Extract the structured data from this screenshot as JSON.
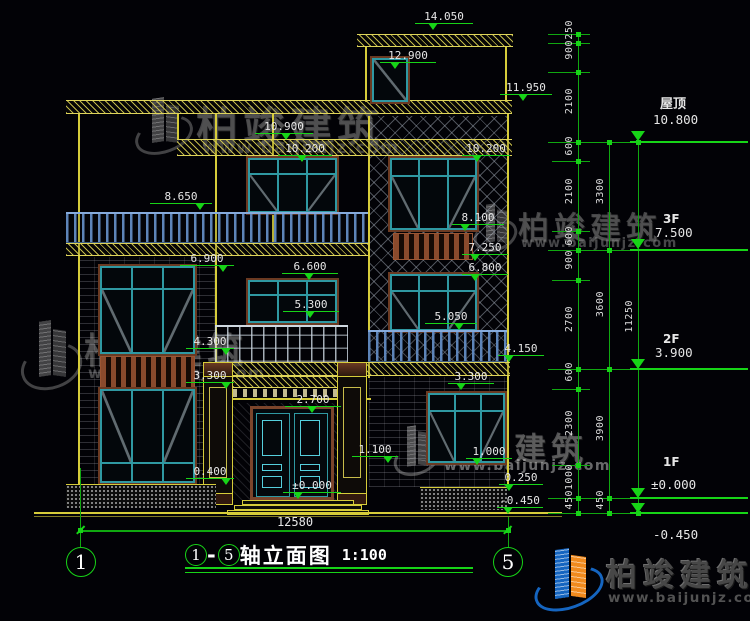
{
  "titlebar": {
    "axis_start": "1",
    "axis_end": "5",
    "dash": "-",
    "title": "轴立面图",
    "scale": "1:100"
  },
  "overall_width": "12580",
  "axis_bubbles": {
    "left": "1",
    "right": "5"
  },
  "markers": {
    "m14050": "14.050",
    "m12900": "12.900",
    "m11950": "11.950",
    "m10900": "10.900",
    "m10200c": "10.200",
    "m10200r": "10.200",
    "m8650": "8.650",
    "m8100": "8.100",
    "m7250": "7.250",
    "m6900": "6.900",
    "m6800": "6.800",
    "m6600": "6.600",
    "m5300": "5.300",
    "m5050": "5.050",
    "m4300": "4.300",
    "m4150": "4.150",
    "m3300l": "3.300",
    "m3300r": "3.300",
    "m2700": "2.700",
    "m1100": "1.100",
    "m1000": "1.000",
    "m0400": "0.400",
    "m0250": "0.250",
    "m0000": "±0.000",
    "mneg0450": "-0.450"
  },
  "levels": {
    "roof_label": "屋顶",
    "roof_value": "10.800",
    "f3_label": "3F",
    "f3_value": "7.500",
    "f2_label": "2F",
    "f2_value": "3.900",
    "f1_label": "1F",
    "f1_value": "±0.000",
    "ground_value": "-0.450"
  },
  "chains": {
    "inner": [
      "250",
      "900",
      "2100",
      "600",
      "2100",
      "600",
      "900",
      "2700",
      "600",
      "2300",
      "1000",
      "450"
    ],
    "middle": [
      "3300",
      "3600",
      "3900",
      "450"
    ],
    "outer": [
      "11250"
    ]
  },
  "watermark": {
    "name": "柏竣建筑",
    "url": "www.baijunjz.com"
  },
  "colors": {
    "cad_yellow": "#d6cc3a",
    "cad_green": "#17d417",
    "teal_frame": "#2f98a2",
    "logo_blue": "#1565c0",
    "logo_orange": "#f08a1d"
  }
}
